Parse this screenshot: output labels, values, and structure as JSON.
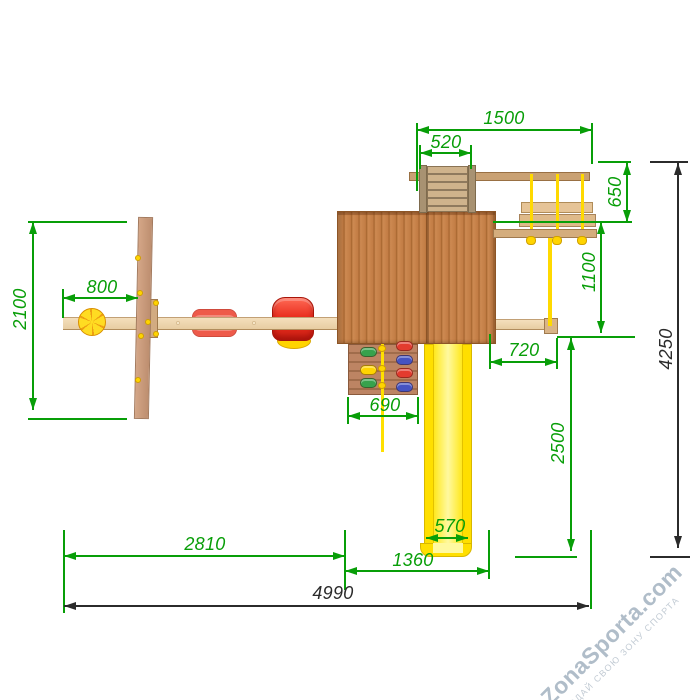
{
  "watermark": {
    "brand": "ZonaSporta.com",
    "tagline": "СОЗДАЙ СВОЮ ЗОНУ СПОРТА"
  },
  "dimensions": {
    "beam_span": "1500",
    "ladder_width": "520",
    "swing_drop": "650",
    "bench_to_beam": "1100",
    "overall_depth": "4250",
    "board_length": "2100",
    "ball_offset": "800",
    "beam_overhang": "720",
    "climb_wall_width": "690",
    "slide_run": "2500",
    "slide_width": "570",
    "slide_offset": "1360",
    "left_span": "2810",
    "overall_width": "4990"
  },
  "colors": {
    "dimension_green": "#089e08",
    "dimension_black": "#2b2b2b",
    "platform_wood": "#c9854e",
    "beam_wood": "#eed7b2",
    "slide_yellow": "#ffdf00",
    "rope_yellow": "#ffd900",
    "seat_red": "#e93528",
    "watermark_gray_blue": "#b0bdc9"
  }
}
